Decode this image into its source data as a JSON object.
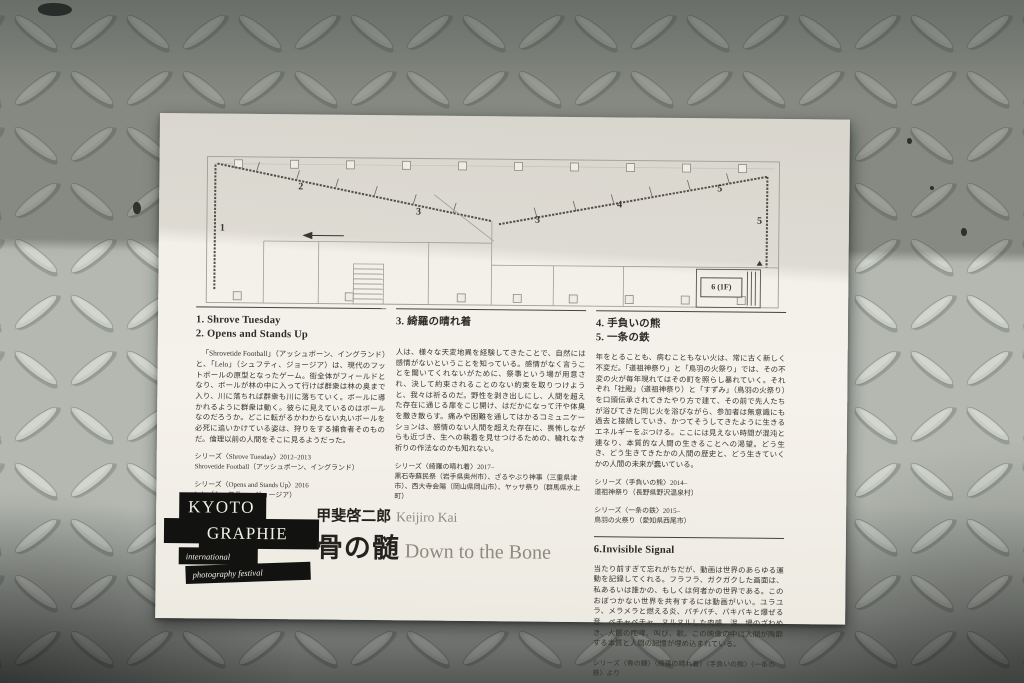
{
  "colors": {
    "paper": "#f5f2eb",
    "ink": "#2b2a25",
    "logo_black": "#121210",
    "title_gray": "#8d8a80",
    "metal_lit": "#b7bab3",
    "metal_shadow": "#7d8179"
  },
  "flyer": {
    "plan": {
      "zones": [
        "1",
        "2",
        "3",
        "3",
        "4",
        "5",
        "5"
      ],
      "stair_label": "6 (1F)"
    },
    "sections": {
      "s12": {
        "heading1": "1. Shrove Tuesday",
        "heading2": "2. Opens and Stands Up",
        "body": "「Shrovetide Football」（アッシュボーン、イングランド）と、「Lelo」（シュフティ、ジョージア）は、現代のフットボールの原型となったゲーム。街全体がフィールドとなり、ボールが林の中に入って行けば群衆は林の奥まで入り、川に落ちれば群衆も川に落ちていく。ボールに導かれるように群衆は動く。彼らに見えているのはボールなのだろうか。どこに転がるかわからない丸いボールを必死に追いかけている姿は、狩りをする捕食者そのものだ。倫理以前の人間をそこに見るようだった。",
        "credit1_series": "シリーズ〈Shrove Tuesday〉2012–2013",
        "credit1_detail": "Shrovetide Football（アッシュボーン、イングランド）",
        "credit2_series": "シリーズ〈Opens and Stands Up〉2016",
        "credit2_detail": "Lelo（シュフティ、ジョージア）"
      },
      "s3": {
        "heading": "3. 綺羅の晴れ着",
        "body": "人は、様々な天変地異を経験してきたことで、自然には感情がないということを知っている。感情がなく言うことを聞いてくれないがために、祭事という場が用意され、決して約束されることのない約束を取りつけようと、我々は祈るのだ。野性を剥き出しにし、人間を超えた存在に通じる扉をこじ開け、はだかになって汗や体臭を撒き散らす。痛みや困難を通してはかるコミュニケーションは、感情のない人間を超えた存在に、畏怖しながらも近づき、生への執着を見せつけるための、穢れなき祈りの作法なのかも知れない。",
        "credit_series": "シリーズ〈綺羅の晴れ着〉2017–",
        "credit_detail": "黒石寺蘇民祭（岩手県奥州市）、ざるやぶり神事（三重県津市）、西大寺会陽（岡山県岡山市）、ヤッサ祭り（群馬県水上町）"
      },
      "s45": {
        "heading1": "4. 手負いの熊",
        "heading2": "5. 一条の鉄",
        "body": "年をとることも、病むこともない火は、常に古く新しく不変だ。「道祖神祭り」と「鳥羽の火祭り」では、その不変の火が毎年現れてはその町を照らし暴れていく。それぞれ「社殿」（道祖神祭り）と「すずみ」（鳥羽の火祭り）を口頭伝承されてきたやり方で建て、その前で先人たちが浴びてきた同じ火を浴びながら、参加者は無意識にも過去と接続していき、かつてそうしてきたように生きるエネルギーをぶつける。ここには見えない時間が混沌と連なり、本質的な人間の生きることへの渇望。どう生き、どう生きてきたかの人間の歴史と、どう生きていくかの人間の未来が蠢いている。",
        "credit1_series": "シリーズ〈手負いの熊〉2014–",
        "credit1_detail": "道祖神祭り（長野県野沢温泉村）",
        "credit2_series": "シリーズ〈一条の鉄〉2015–",
        "credit2_detail": "鳥羽の火祭り（愛知県西尾市）"
      },
      "s6": {
        "heading": "6.Invisible Signal",
        "body": "当たり前すぎて忘れがちだが、動画は世界のあらゆる運動を記録してくれる。フラフラ、ガクガクした画面は、私あるいは誰かの、もしくは何者かの世界である。このおぼつかない世界を共有するには動画がいい。ユラユラ、メラメラと燃える炎、パチパチ、バキバキと爆ぜる音、ペチャペチャ、ヌルヌルした肉感、泥、場のざわめき、人間の咆哮、叫び、歌。この映像の中に人間が陶酔する本質と人間の記憶が埋め込まれている。",
        "source": "シリーズ〈骨の髄〉〈綺羅の晴れ着〉〈手負いの熊〉〈一条の鉄〉より",
        "video_credit": "映像編集：松見拓也",
        "special_thanks": "Special Thanks：河野亮介、大澤未来、大嶌なつみ"
      }
    },
    "logo": {
      "line1": "KYOTO",
      "line2": "GRAPHIE",
      "line3": "international",
      "line4": "photography festival"
    },
    "title": {
      "artist_ja": "甲斐啓二郎",
      "artist_en": "Keijiro Kai",
      "work_ja": "骨の髄",
      "work_en": "Down to the Bone"
    }
  }
}
